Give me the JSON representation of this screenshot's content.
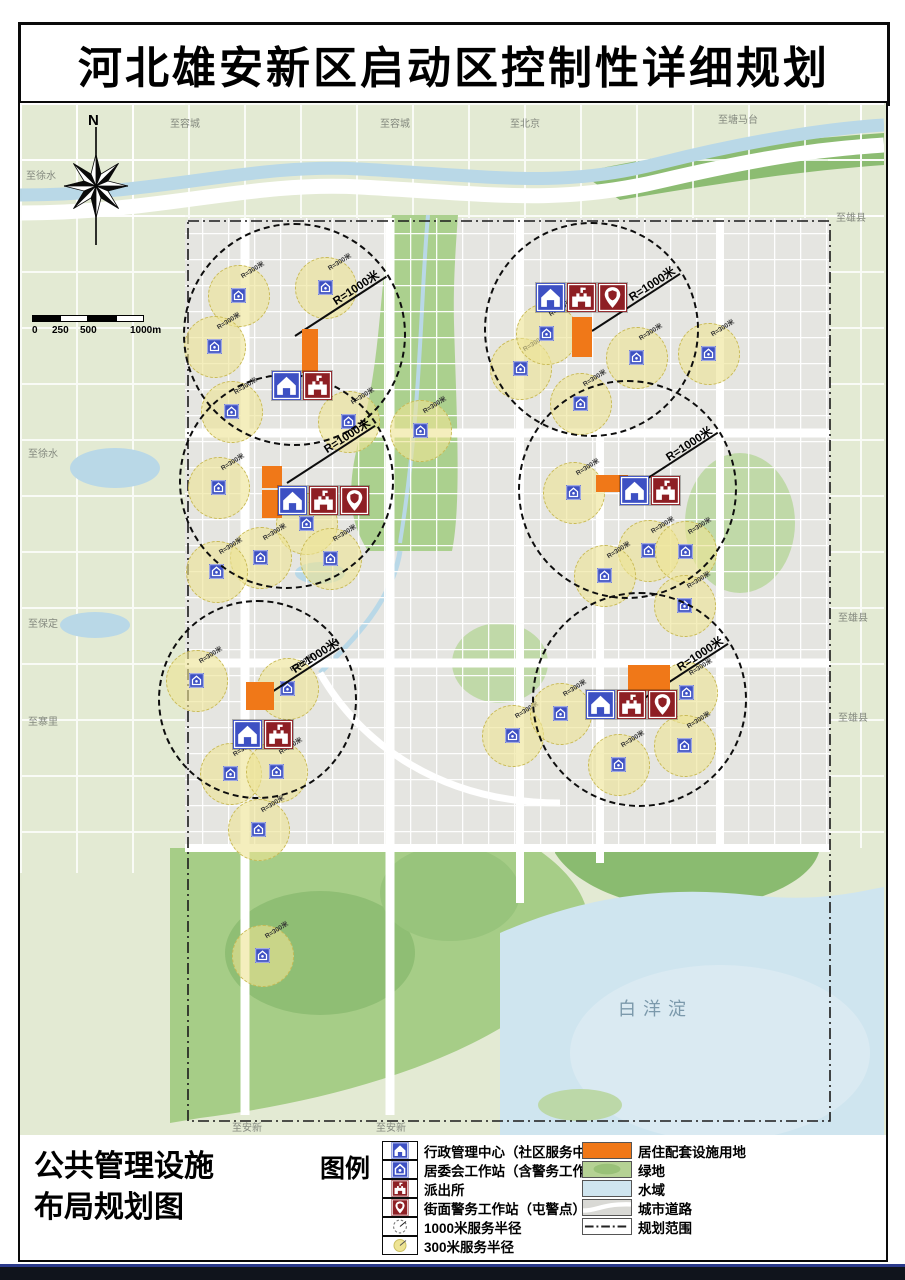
{
  "title": "河北雄安新区启动区控制性详细规划",
  "footer": {
    "left_title_lines": [
      "公共管理设施",
      "布局规划图"
    ],
    "legend_title": "图例",
    "legend_left": [
      {
        "icon": "admin",
        "label": "行政管理中心（社区服务中心）"
      },
      {
        "icon": "committee",
        "label": "居委会工作站（含警务工作站）"
      },
      {
        "icon": "police",
        "label": "派出所"
      },
      {
        "icon": "pin",
        "label": "街面警务工作站（屯警点）"
      },
      {
        "icon": "r1000",
        "label": "1000米服务半径"
      },
      {
        "icon": "r300",
        "label": "300米服务半径"
      }
    ],
    "legend_right": [
      {
        "swatch": "orange",
        "label": "居住配套设施用地"
      },
      {
        "swatch": "green",
        "label": "绿地"
      },
      {
        "swatch": "water",
        "label": "水域"
      },
      {
        "swatch": "road",
        "label": "城市道路"
      },
      {
        "swatch": "boundary",
        "label": "规划范围"
      }
    ]
  },
  "map": {
    "north_label": "N",
    "scale_labels": [
      "0",
      "250",
      "500",
      "1000m"
    ],
    "water_label": "白洋淀",
    "r1000_label": "R=1000米",
    "r300_label": "R=300米",
    "edge_labels": [
      {
        "text": "至容城",
        "x": 150,
        "y": 12
      },
      {
        "text": "至容城",
        "x": 360,
        "y": 12
      },
      {
        "text": "至北京",
        "x": 490,
        "y": 12
      },
      {
        "text": "至塘马台",
        "x": 698,
        "y": 8
      },
      {
        "text": "至雄县",
        "x": 816,
        "y": 106
      },
      {
        "text": "至雄县",
        "x": 818,
        "y": 506
      },
      {
        "text": "至雄县",
        "x": 818,
        "y": 606
      },
      {
        "text": "至徐水",
        "x": 6,
        "y": 64
      },
      {
        "text": "至徐水",
        "x": 8,
        "y": 342
      },
      {
        "text": "至保定",
        "x": 8,
        "y": 512
      },
      {
        "text": "至寨里",
        "x": 8,
        "y": 610
      },
      {
        "text": "至安新",
        "x": 212,
        "y": 1016
      },
      {
        "text": "至安新",
        "x": 356,
        "y": 1016
      }
    ],
    "service_circles_1000": [
      {
        "cx": 275,
        "cy": 232,
        "r": 112
      },
      {
        "cx": 572,
        "cy": 227,
        "r": 108
      },
      {
        "cx": 267,
        "cy": 379,
        "r": 108
      },
      {
        "cx": 608,
        "cy": 387,
        "r": 110
      },
      {
        "cx": 238,
        "cy": 597,
        "r": 100
      },
      {
        "cx": 620,
        "cy": 597,
        "r": 108
      }
    ],
    "service_circles_300": [
      {
        "cx": 218,
        "cy": 192
      },
      {
        "cx": 305,
        "cy": 184
      },
      {
        "cx": 194,
        "cy": 243
      },
      {
        "cx": 211,
        "cy": 308
      },
      {
        "cx": 328,
        "cy": 318
      },
      {
        "cx": 500,
        "cy": 265
      },
      {
        "cx": 526,
        "cy": 230
      },
      {
        "cx": 616,
        "cy": 254
      },
      {
        "cx": 688,
        "cy": 250
      },
      {
        "cx": 560,
        "cy": 300
      },
      {
        "cx": 198,
        "cy": 384
      },
      {
        "cx": 286,
        "cy": 420
      },
      {
        "cx": 240,
        "cy": 454
      },
      {
        "cx": 310,
        "cy": 455
      },
      {
        "cx": 196,
        "cy": 468
      },
      {
        "cx": 553,
        "cy": 389
      },
      {
        "cx": 628,
        "cy": 447
      },
      {
        "cx": 665,
        "cy": 448
      },
      {
        "cx": 664,
        "cy": 502
      },
      {
        "cx": 584,
        "cy": 472
      },
      {
        "cx": 176,
        "cy": 577
      },
      {
        "cx": 267,
        "cy": 585
      },
      {
        "cx": 210,
        "cy": 670
      },
      {
        "cx": 256,
        "cy": 668
      },
      {
        "cx": 238,
        "cy": 726
      },
      {
        "cx": 492,
        "cy": 632
      },
      {
        "cx": 666,
        "cy": 589
      },
      {
        "cx": 598,
        "cy": 661
      },
      {
        "cx": 664,
        "cy": 642
      },
      {
        "cx": 540,
        "cy": 610
      },
      {
        "cx": 400,
        "cy": 327
      },
      {
        "cx": 242,
        "cy": 852
      }
    ],
    "facility_clusters": [
      {
        "x": 252,
        "y": 268,
        "icons": [
          "admin",
          "police"
        ]
      },
      {
        "x": 516,
        "y": 180,
        "icons": [
          "admin",
          "police",
          "pin"
        ]
      },
      {
        "x": 258,
        "y": 383,
        "icons": [
          "admin",
          "police",
          "pin"
        ]
      },
      {
        "x": 600,
        "y": 373,
        "icons": [
          "admin",
          "police"
        ]
      },
      {
        "x": 213,
        "y": 617,
        "icons": [
          "admin",
          "police"
        ]
      },
      {
        "x": 566,
        "y": 587,
        "icons": [
          "admin",
          "police",
          "pin"
        ]
      }
    ],
    "orange_parcels": [
      {
        "x": 282,
        "y": 226,
        "w": 16,
        "h": 44
      },
      {
        "x": 552,
        "y": 214,
        "w": 20,
        "h": 40
      },
      {
        "x": 242,
        "y": 363,
        "w": 20,
        "h": 22
      },
      {
        "x": 242,
        "y": 387,
        "w": 20,
        "h": 28
      },
      {
        "x": 576,
        "y": 372,
        "w": 32,
        "h": 17
      },
      {
        "x": 226,
        "y": 579,
        "w": 28,
        "h": 28
      },
      {
        "x": 608,
        "y": 562,
        "w": 42,
        "h": 26
      }
    ],
    "colors": {
      "admin_blue": "#3d50c3",
      "police_red": "#8e1f24",
      "residential_orange": "#f07818",
      "green": "#a8cd89",
      "water": "#cfe5ef",
      "circle300_fill": "#eee494"
    }
  }
}
